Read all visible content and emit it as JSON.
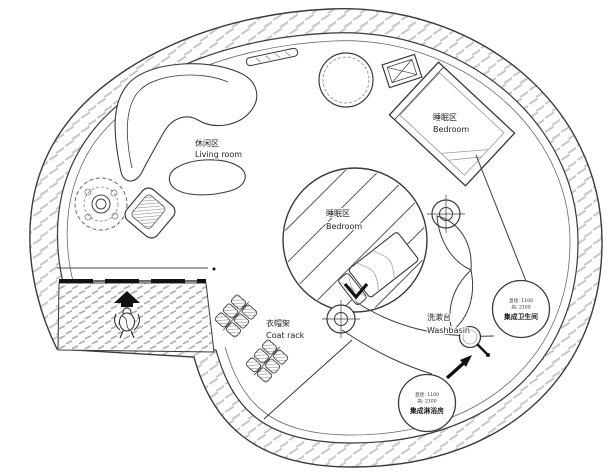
{
  "meta": {
    "drawing_type": "circular tiny-house floor plan",
    "background_color": "#ffffff",
    "line_color": "#3a3a3a",
    "wall_hatch_color": "#c9c9c9",
    "deck_hatch_color": "#adadad",
    "door_color": "#111111"
  },
  "labels": {
    "living": {
      "zh": "休闲区",
      "en": "Living room"
    },
    "bedroom_upper": {
      "zh": "睡眠区",
      "en": "Bedroom"
    },
    "bedroom_loft": {
      "zh": "睡眠区",
      "en": "Bedroom"
    },
    "coat_rack": {
      "zh": "衣帽架",
      "en": "Coat rack"
    },
    "washbasin": {
      "zh": "洗漱台",
      "en": "Washbasin"
    }
  },
  "pods": {
    "toilet": {
      "spec_line1": "直径: 1100",
      "spec_line2": "高: 2100",
      "name": "集成卫生间"
    },
    "shower": {
      "spec_line1": "直径: 1100",
      "spec_line2": "高: 2100",
      "name": "集成淋浴房"
    }
  }
}
